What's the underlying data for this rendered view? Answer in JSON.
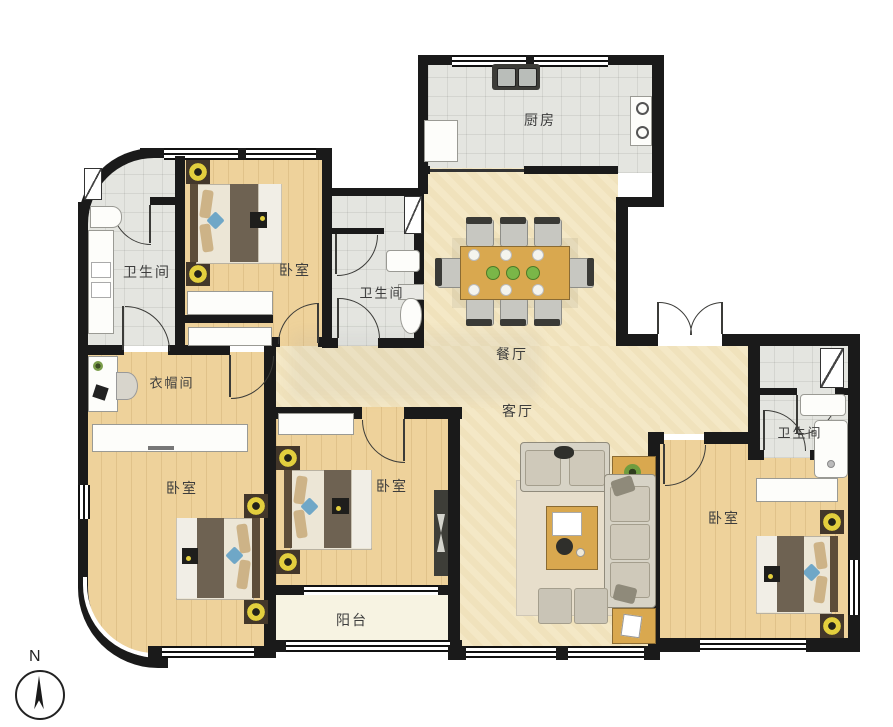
{
  "plan": {
    "compass_label": "N",
    "rooms": {
      "kitchen": "厨房",
      "bath_top_left": "卫生间",
      "bed_top": "卧室",
      "bath_middle": "卫生间",
      "dining": "餐厅",
      "living": "客厅",
      "cloakroom": "衣帽间",
      "bed_left": "卧室",
      "bed_middle": "卧室",
      "balcony": "阳台",
      "bath_right": "卫生间",
      "bed_right": "卧室"
    },
    "colors": {
      "wall": "#1a1a1a",
      "wood_floor": "#eed29b",
      "open_floor": "#f4e8c6",
      "tile_floor": "#e4e5e0",
      "balcony_floor": "#f7f3e2",
      "label_text": "#3d3d3d",
      "table_wood": "#d9a84f",
      "plant_green": "#7ab648",
      "lamp_yellow": "#e3cf3e",
      "pillow_blue": "#6fa7c7"
    }
  }
}
